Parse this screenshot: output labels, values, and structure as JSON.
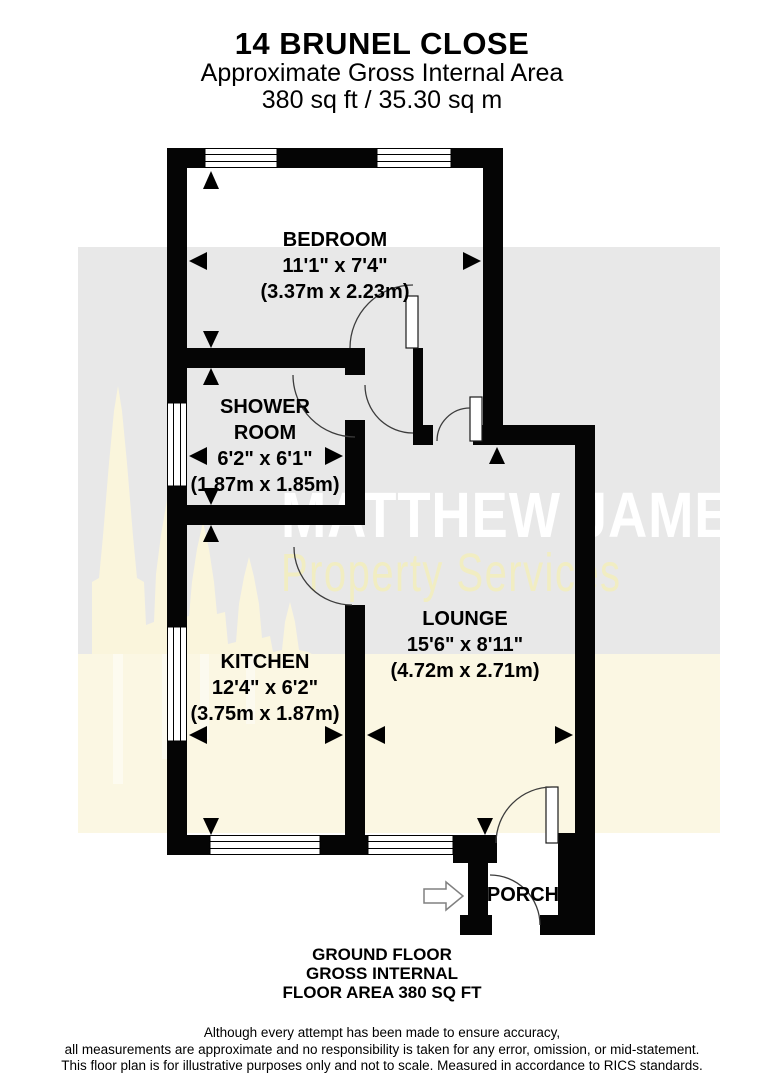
{
  "header": {
    "title": "14 BRUNEL CLOSE",
    "subtitle": "Approximate Gross Internal Area",
    "area": "380 sq ft / 35.30 sq m"
  },
  "rooms": [
    {
      "name": "BEDROOM",
      "imperial": "11'1\" x 7'4\"",
      "metric": "(3.37m x 2.23m)"
    },
    {
      "name": "SHOWER ROOM",
      "imperial": "6'2\" x 6'1\"",
      "metric": "(1.87m x 1.85m)"
    },
    {
      "name": "KITCHEN",
      "imperial": "12'4\" x 6'2\"",
      "metric": "(3.75m x 1.87m)"
    },
    {
      "name": "LOUNGE",
      "imperial": "15'6\" x 8'11\"",
      "metric": "(4.72m x 2.71m)"
    },
    {
      "name": "PORCH"
    }
  ],
  "watermark": {
    "brand": "MATTHEW JAMES",
    "tagline": "Property Services"
  },
  "footer": {
    "floor_lines": [
      "GROUND FLOOR",
      "GROSS INTERNAL",
      "FLOOR AREA 380 SQ FT"
    ],
    "disclaimer_lines": [
      "Although every attempt has been made to ensure accuracy,",
      "all measurements are approximate and no responsibility is taken for any error, omission, or mid-statement.",
      "This floor plan is for illustrative purposes only and not to scale. Measured in accordance to RICS standards."
    ]
  },
  "icons": {
    "entry_arrow": "right-arrow-entry-indicator",
    "dimension_arrow": "black-triangle"
  },
  "colors": {
    "wall": "#050505",
    "band_gray": "#e8e8e8",
    "band_cream": "#fbf7e3",
    "cathedral": "#faf5dc",
    "watermark_brand": "#ffffff",
    "watermark_tagline": "#f1edc2",
    "door_arc": "#3c3c3c"
  }
}
